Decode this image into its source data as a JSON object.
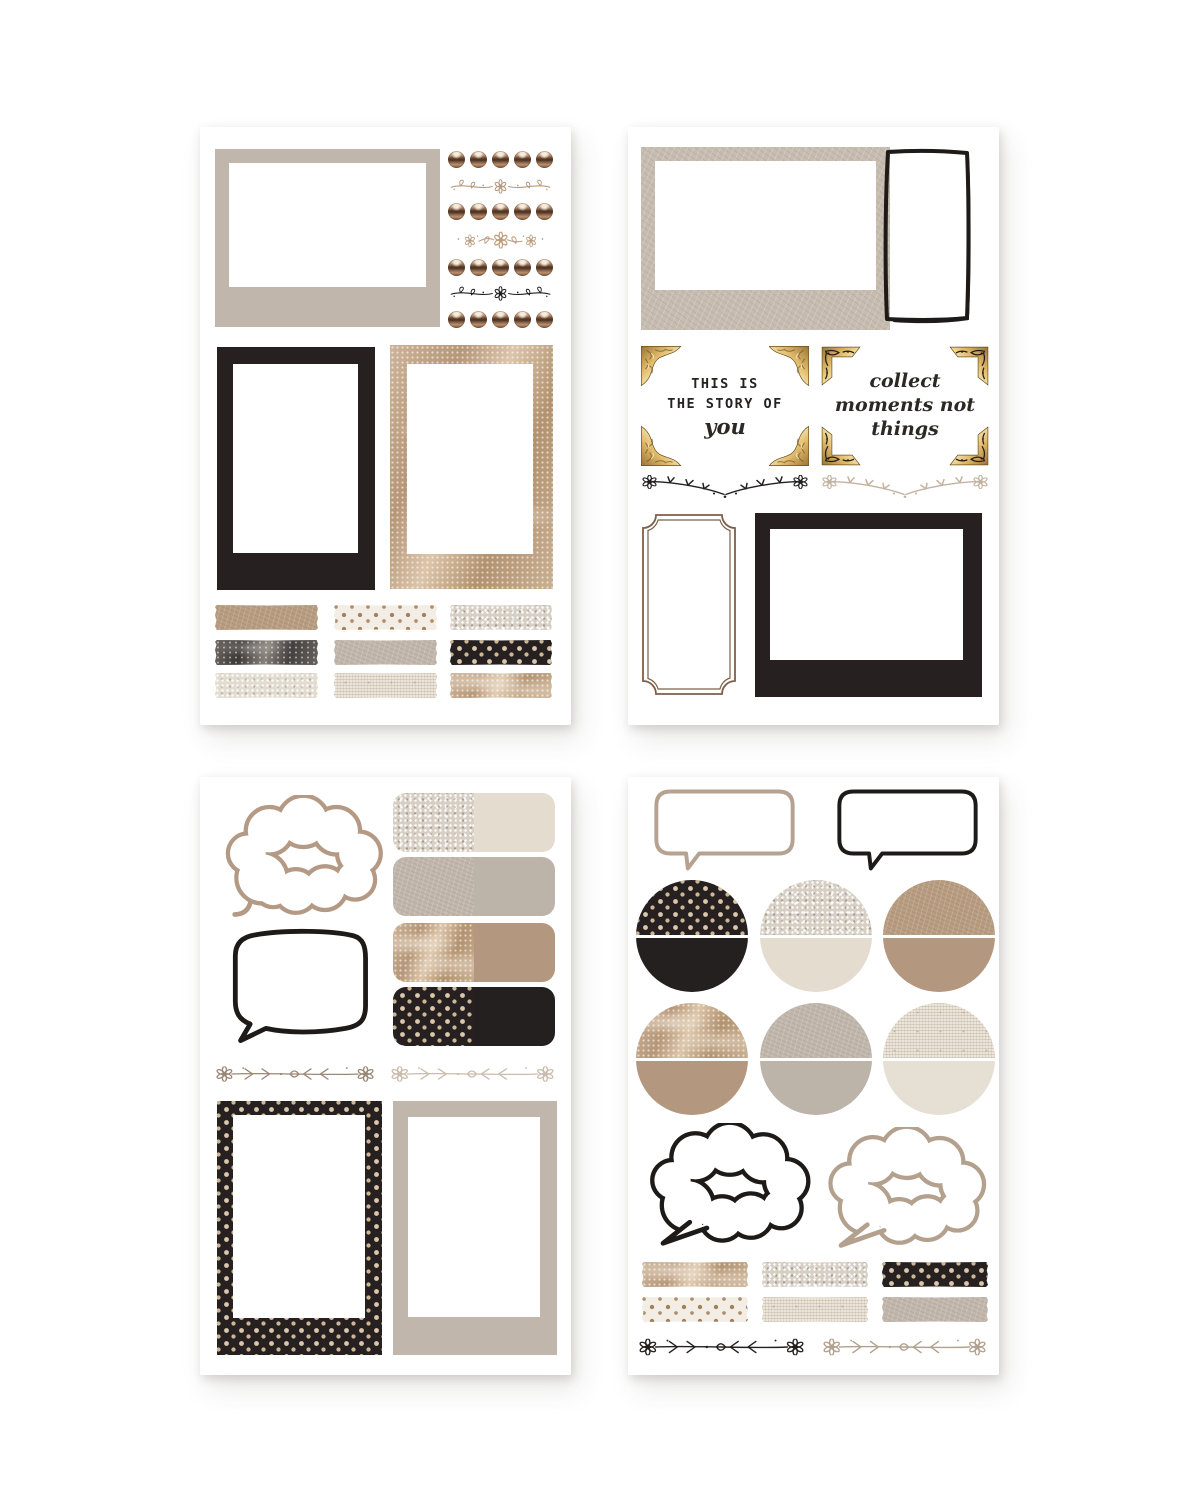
{
  "page": {
    "title": "Neutral journaling sticker sheets",
    "background": "#ffffff",
    "grid": "2x2 sheets"
  },
  "palette": {
    "sheet_white": "#ffffff",
    "beige_frame": "#c1b6ab",
    "black": "#242020",
    "ink": "#1d1a18",
    "tan_leather": "#b89d81",
    "taupe_leather": "#c1b7ac",
    "beige_leather": "#c7bcb0",
    "silver_glitter": "#d7cfc4",
    "cream": "#e4dccf",
    "tan_marble": "#c0a488",
    "dark_marble": "#55504b",
    "cream_linen": "#ece5d9",
    "dot_gold": "#dbc7ab",
    "dot_brown": "#a5805f",
    "bronze_brad": "#7c5137",
    "gold": "#d9b264",
    "ticket_brown": "#7d5f49",
    "vine_beige": "#b79a7e",
    "vine_taupe": "#9b8775",
    "vine_light": "#cbbcab",
    "script_ink": "#2c2823"
  },
  "quotes": {
    "story": {
      "line1": "THIS IS",
      "line2": "THE STORY OF",
      "line3": "you"
    },
    "collect": {
      "line1": "collect",
      "line2": "moments not",
      "line3": "things"
    }
  },
  "sheets": [
    {
      "id": "top-left",
      "contents": [
        {
          "type": "polaroid-frame",
          "orientation": "landscape",
          "texture": "beige-flat"
        },
        {
          "type": "brad-dot-rows",
          "rows": 4,
          "dots_per_row": 5,
          "finish": "bronze-metallic"
        },
        {
          "type": "flourish-divider",
          "style": "daisy-vine",
          "color": "#b79a7e"
        },
        {
          "type": "flourish-divider",
          "style": "daisy-trio",
          "color": "#bd9f80"
        },
        {
          "type": "flourish-divider",
          "style": "daisy-vine",
          "color": "#242020"
        },
        {
          "type": "polaroid-frame",
          "orientation": "portrait",
          "texture": "black-flat"
        },
        {
          "type": "photo-frame",
          "orientation": "portrait",
          "texture": "tan-glitter-marble"
        },
        {
          "type": "washi-tape-grid",
          "tapes": [
            "tan-leather",
            "cream-dots",
            "silver-glitter",
            "dark-marble",
            "taupe-leather",
            "black-dots",
            "light-glitter",
            "cream-linen",
            "tan-marble"
          ]
        }
      ]
    },
    {
      "id": "top-right",
      "contents": [
        {
          "type": "polaroid-frame",
          "orientation": "landscape",
          "texture": "beige-leather"
        },
        {
          "type": "hand-drawn-frame",
          "orientation": "portrait",
          "color": "#1d1a18"
        },
        {
          "type": "quote-card",
          "corners": "gold-carved",
          "text": "THIS IS THE STORY OF you"
        },
        {
          "type": "quote-card",
          "corners": "gold-scroll",
          "text": "collect moments not things"
        },
        {
          "type": "flourish-divider",
          "style": "vee-branch",
          "color": "#242020"
        },
        {
          "type": "flourish-divider",
          "style": "vee-branch",
          "color": "#c3b2a0"
        },
        {
          "type": "ticket-frame",
          "color": "#7d5f49"
        },
        {
          "type": "polaroid-frame",
          "orientation": "landscape",
          "texture": "black-flat"
        }
      ]
    },
    {
      "id": "bottom-left",
      "contents": [
        {
          "type": "cloud-speech-bubble",
          "outline": "#b49a84",
          "tail": "curl"
        },
        {
          "type": "texture-tab",
          "halves": [
            "silver-glitter",
            "cream"
          ]
        },
        {
          "type": "texture-tab",
          "halves": [
            "taupe-leather",
            "taupe"
          ]
        },
        {
          "type": "texture-tab",
          "halves": [
            "tan-marble",
            "tan"
          ]
        },
        {
          "type": "texture-tab",
          "halves": [
            "black-dots",
            "black"
          ]
        },
        {
          "type": "speech-bubble",
          "shape": "rounded-square",
          "outline": "#1d1a18"
        },
        {
          "type": "flourish-divider",
          "style": "leaf-line",
          "color": "#9b8775"
        },
        {
          "type": "flourish-divider",
          "style": "leaf-line",
          "color": "#cbbcab"
        },
        {
          "type": "polaroid-frame",
          "orientation": "portrait",
          "texture": "black-gold-dots"
        },
        {
          "type": "photo-frame",
          "orientation": "portrait",
          "texture": "beige-flat"
        }
      ]
    },
    {
      "id": "bottom-right",
      "contents": [
        {
          "type": "rect-speech-bubble",
          "outline": "#b6a291"
        },
        {
          "type": "rect-speech-bubble",
          "outline": "#1d1a18"
        },
        {
          "type": "half-circle-sticker",
          "halves": [
            "black-dots",
            "black"
          ]
        },
        {
          "type": "half-circle-sticker",
          "halves": [
            "silver-glitter",
            "cream"
          ]
        },
        {
          "type": "half-circle-sticker",
          "halves": [
            "tan-leather",
            "tan"
          ]
        },
        {
          "type": "half-circle-sticker",
          "halves": [
            "tan-marble",
            "tan"
          ]
        },
        {
          "type": "half-circle-sticker",
          "halves": [
            "taupe-leather",
            "taupe"
          ]
        },
        {
          "type": "half-circle-sticker",
          "halves": [
            "cream-linen",
            "light-cream"
          ]
        },
        {
          "type": "cloud-speech-bubble",
          "outline": "#1d1a18",
          "tail": "point"
        },
        {
          "type": "cloud-speech-bubble",
          "outline": "#b3a08d",
          "tail": "point"
        },
        {
          "type": "washi-tape-grid",
          "tapes": [
            "tan-marble",
            "silver-glitter",
            "black-dots",
            "cream-dots",
            "cream-linen",
            "taupe-leather"
          ]
        },
        {
          "type": "flourish-divider",
          "style": "leaf-line",
          "color": "#242020"
        },
        {
          "type": "flourish-divider",
          "style": "leaf-line",
          "color": "#b3a08d"
        }
      ]
    }
  ]
}
